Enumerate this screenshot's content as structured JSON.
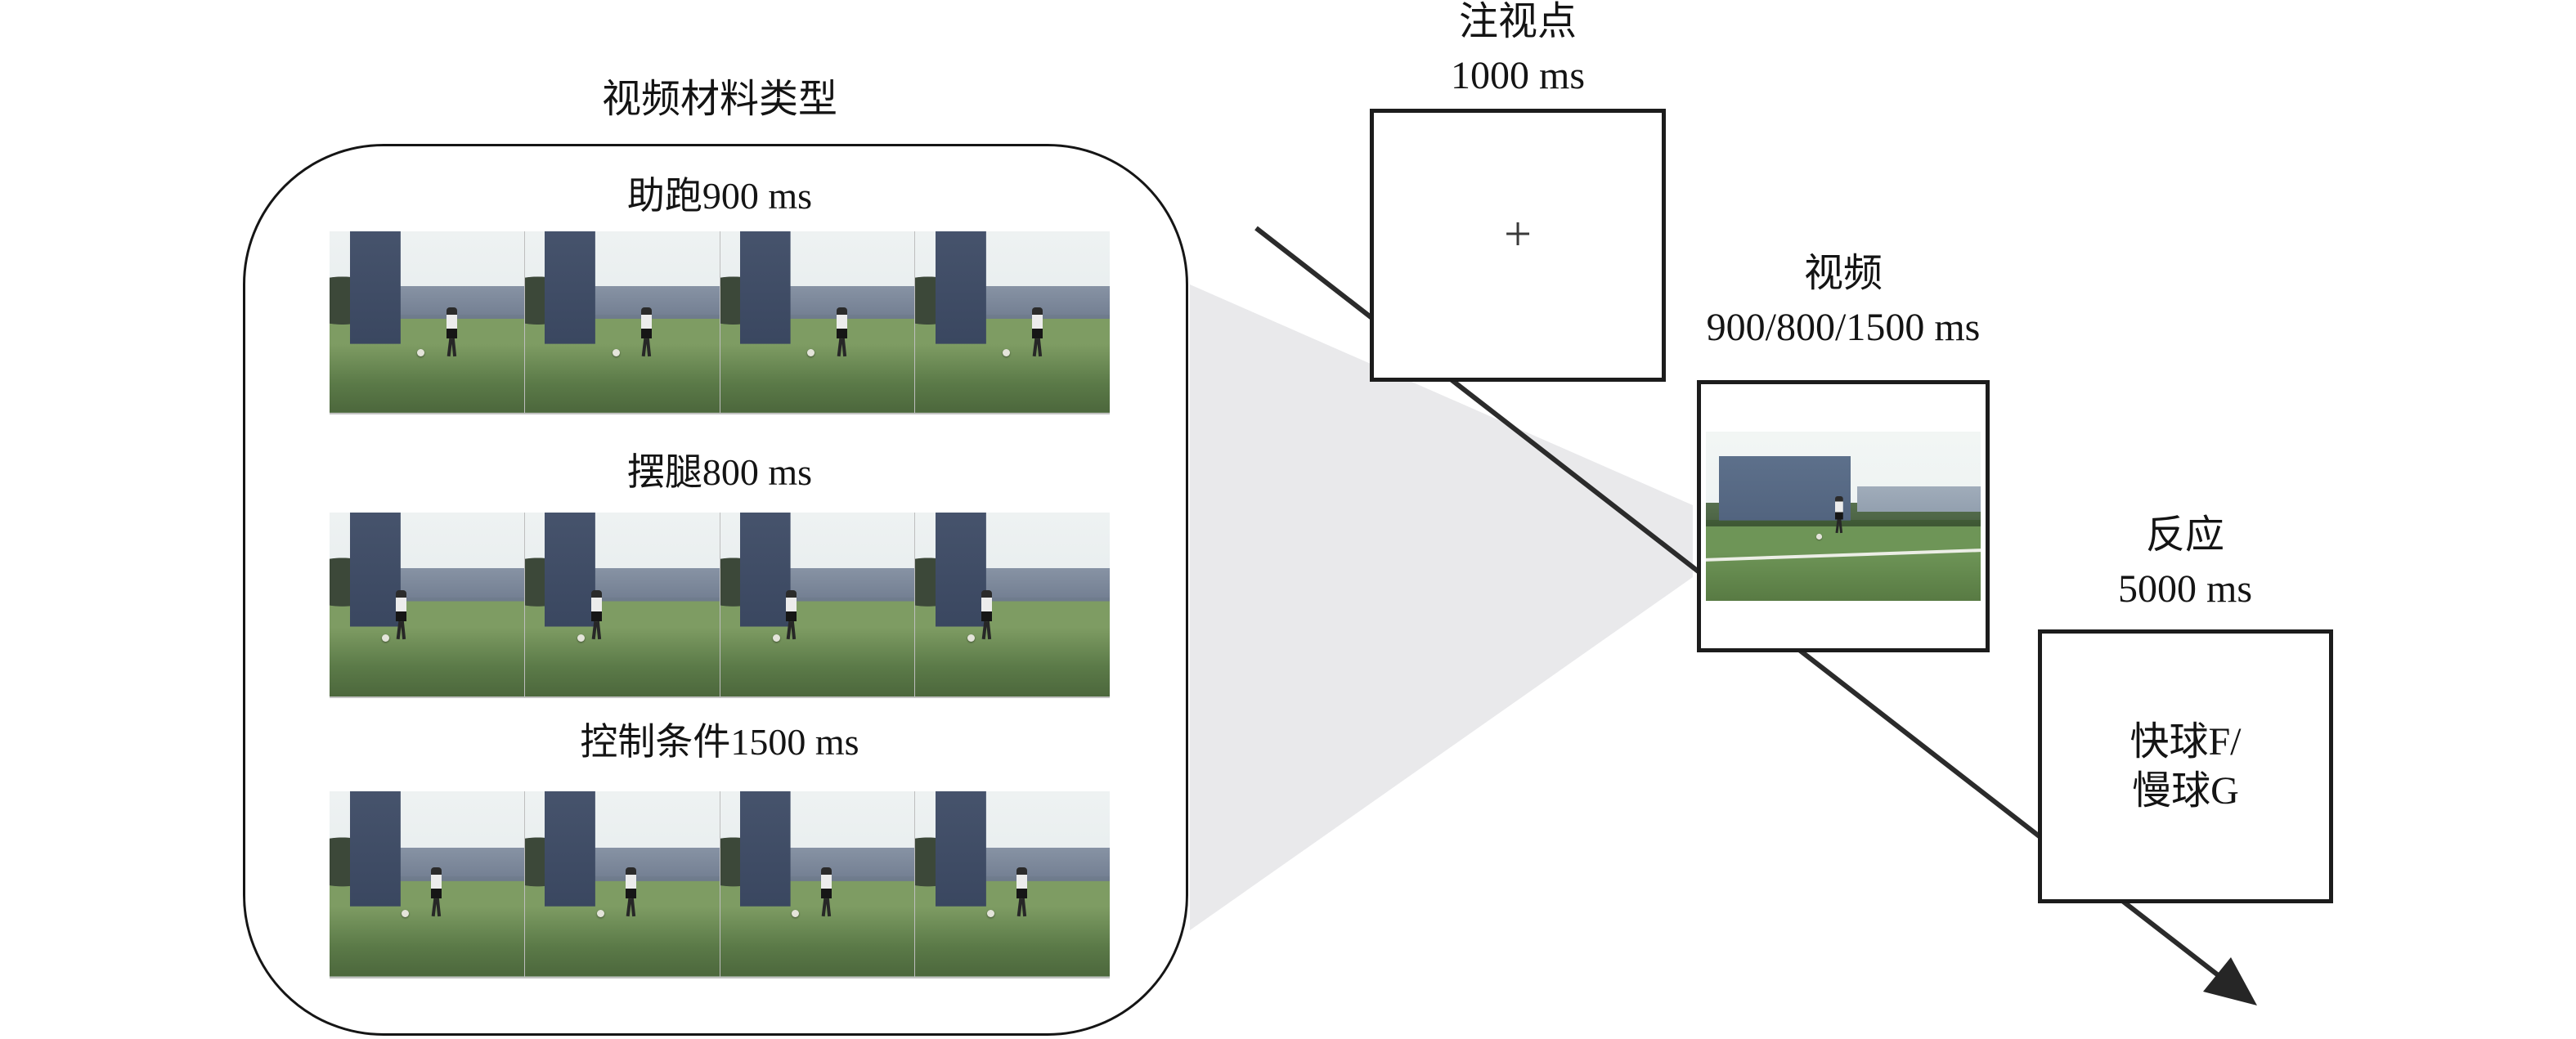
{
  "figure": {
    "panel": {
      "title": "视频材料类型",
      "rows": [
        {
          "label": "助跑900 ms"
        },
        {
          "label": "摆腿800 ms"
        },
        {
          "label": "控制条件1500 ms"
        }
      ]
    },
    "trial": {
      "fixation": {
        "title": "注视点",
        "duration": "1000 ms",
        "cross": "+"
      },
      "video": {
        "title": "视频",
        "duration": "900/800/1500 ms"
      },
      "response": {
        "title": "反应",
        "duration": "5000 ms",
        "line1": "快球F/",
        "line2": "慢球G"
      }
    },
    "colors": {
      "cone": "#e9e9eb",
      "ink": "#1c1c1c",
      "arrow": "#2b2b2b"
    }
  }
}
